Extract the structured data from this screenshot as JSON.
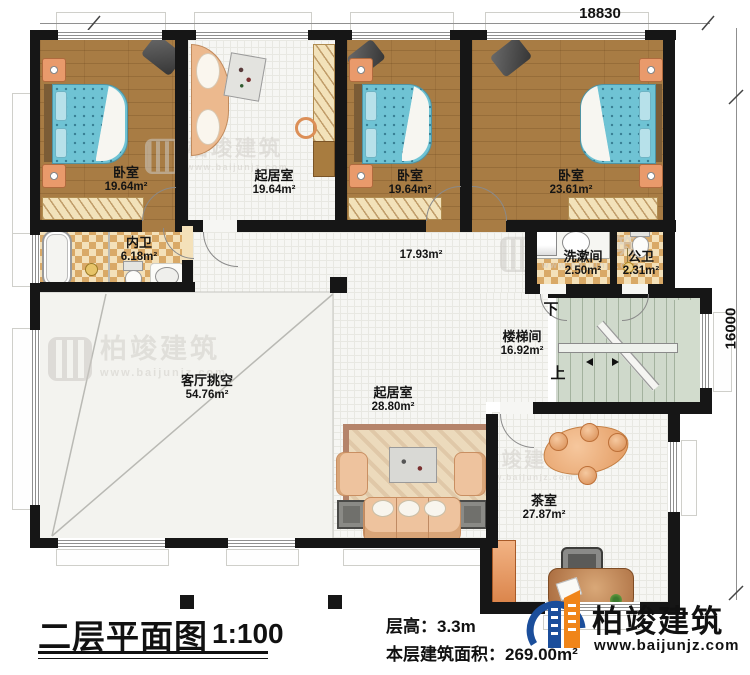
{
  "dimensions": {
    "width_mm": "18830",
    "height_mm": "16000"
  },
  "rooms": {
    "bedroom1": {
      "name": "卧室",
      "area": "19.64m²"
    },
    "sitting_top": {
      "name": "起居室",
      "area": "19.64m²"
    },
    "bedroom2": {
      "name": "卧室",
      "area": "19.64m²"
    },
    "bedroom3": {
      "name": "卧室",
      "area": "23.61m²"
    },
    "inner_bath": {
      "name": "内卫",
      "area": "6.18m²"
    },
    "hall": {
      "area": "17.93m²"
    },
    "washroom": {
      "name": "洗漱间",
      "area": "2.50m²"
    },
    "public_bath": {
      "name": "公卫",
      "area": "2.31m²"
    },
    "stairwell": {
      "name": "楼梯间",
      "area": "16.92m²"
    },
    "living_void": {
      "name": "客厅挑空",
      "area": "54.76m²"
    },
    "sitting_bottom": {
      "name": "起居室",
      "area": "28.80m²"
    },
    "tea_room": {
      "name": "茶室",
      "area": "27.87m²"
    }
  },
  "stairs": {
    "down_label": "下",
    "up_label": "上"
  },
  "titleblock": {
    "title": "二层平面图",
    "scale": "1:100",
    "floor_height": "层高：3.3m",
    "floor_area": "本层建筑面积：269.00m²"
  },
  "brand": {
    "company": "柏竣建筑",
    "website": "www.baijunjz.com"
  },
  "watermark": {
    "company": "柏竣建筑",
    "website": "www.baijunjz.com"
  },
  "colors": {
    "wall": "#161616",
    "wood_floor": "#a87c44",
    "tile_floor": "#f6f6f3",
    "checker_floor": "#d9a967",
    "stair_floor": "#cfd9cb",
    "bed_blue": "#6fc3d4",
    "furniture_peach": "#eec39e",
    "logo_blue": "#1b4e9b",
    "logo_orange": "#f08519"
  }
}
